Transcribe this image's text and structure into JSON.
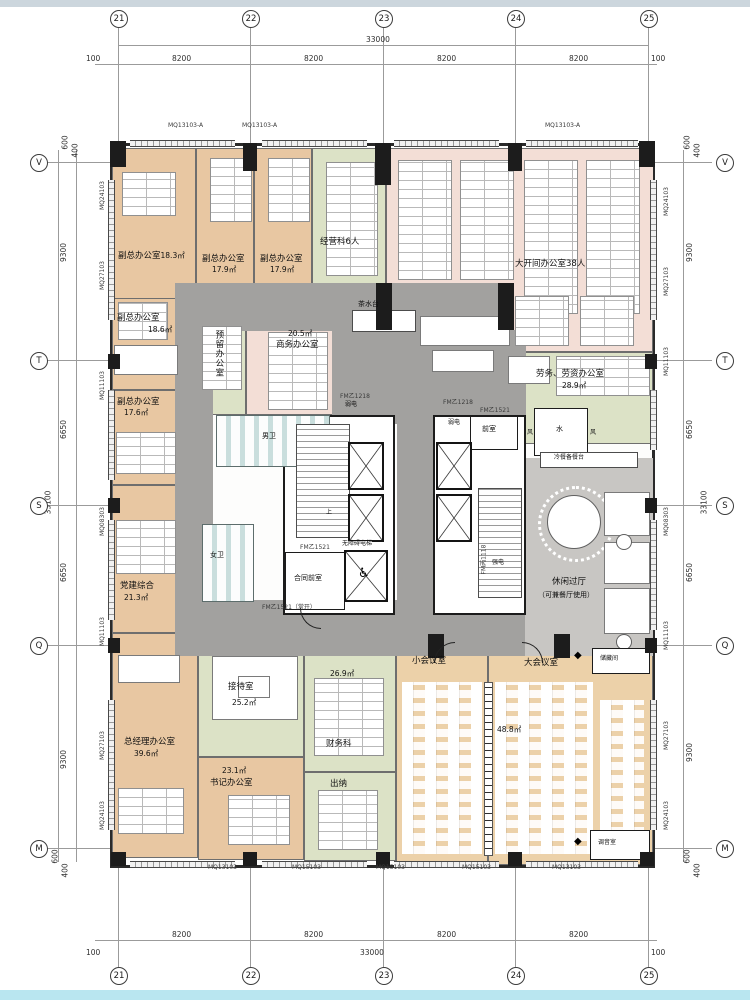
{
  "drawing": {
    "grid_cols": [
      "21",
      "22",
      "23",
      "24",
      "25"
    ],
    "grid_rows": [
      "V",
      "T",
      "S",
      "Q",
      "M"
    ],
    "dims": {
      "total_width": "33000",
      "bay": "8200",
      "edge": "100",
      "total_height": "33100",
      "v_9300": "9300",
      "v_6650": "6650",
      "e600": "600",
      "e400": "400"
    },
    "wall_codes": {
      "mq24": "MQ24103",
      "mq27": "MQ27103",
      "mq11": "MQ11103",
      "mq08": "MQ08303",
      "mq13": "MQ13103",
      "mq15": "MQ15103",
      "mq13a": "MQ13103-A"
    },
    "door_codes": {
      "fm_b1218": "FM乙1218",
      "fm_b1521": "FM乙1521",
      "fm_b1521_open": "FM乙1521（常开）",
      "fm_c1118": "FM丙1118"
    },
    "rooms": [
      {
        "name": "副总办公室",
        "area": "18.3㎡"
      },
      {
        "name": "副总办公室",
        "area": "17.9㎡"
      },
      {
        "name": "副总办公室",
        "area": "17.9㎡"
      },
      {
        "name": "经营科6人",
        "area": ""
      },
      {
        "name": "大开间办公室38人",
        "area": ""
      },
      {
        "name": "副总办公室",
        "area": "18.6㎡"
      },
      {
        "name": "副总办公室",
        "area": "17.6㎡"
      },
      {
        "name": "预留办公室",
        "area": ""
      },
      {
        "name": "商务办公室",
        "area": "20.5㎡"
      },
      {
        "name": "劳务、劳资办公室",
        "area": "28.9㎡"
      },
      {
        "name": "休闲过厅",
        "area": "（可兼餐厅使用）"
      },
      {
        "name": "党建综合",
        "area": "21.3㎡"
      },
      {
        "name": "接待室",
        "area": "25.2㎡"
      },
      {
        "name": "总经理办公室",
        "area": "39.6㎡"
      },
      {
        "name": "书记办公室",
        "area": "23.1㎡"
      },
      {
        "name": "财务科",
        "area": "26.9㎡"
      },
      {
        "name": "出纳",
        "area": ""
      },
      {
        "name": "小会议室",
        "area": ""
      },
      {
        "name": "大会议室",
        "area": "48.8㎡"
      },
      {
        "name": "储藏间",
        "area": ""
      },
      {
        "name": "调音室",
        "area": ""
      }
    ],
    "core": {
      "tea": "茶水台",
      "mens": "男卫",
      "womens": "女卫",
      "up": "上",
      "contract_lobby": "合同前室",
      "acc_elevator": "无障碍电梯",
      "front_room": "前室",
      "weak_power": "弱电",
      "strong_power": "强电",
      "water": "水",
      "vent": "风",
      "buffet": "冷餐备餐台"
    },
    "symbols": {
      "wheelchair": "♿",
      "fan": "◆"
    }
  }
}
